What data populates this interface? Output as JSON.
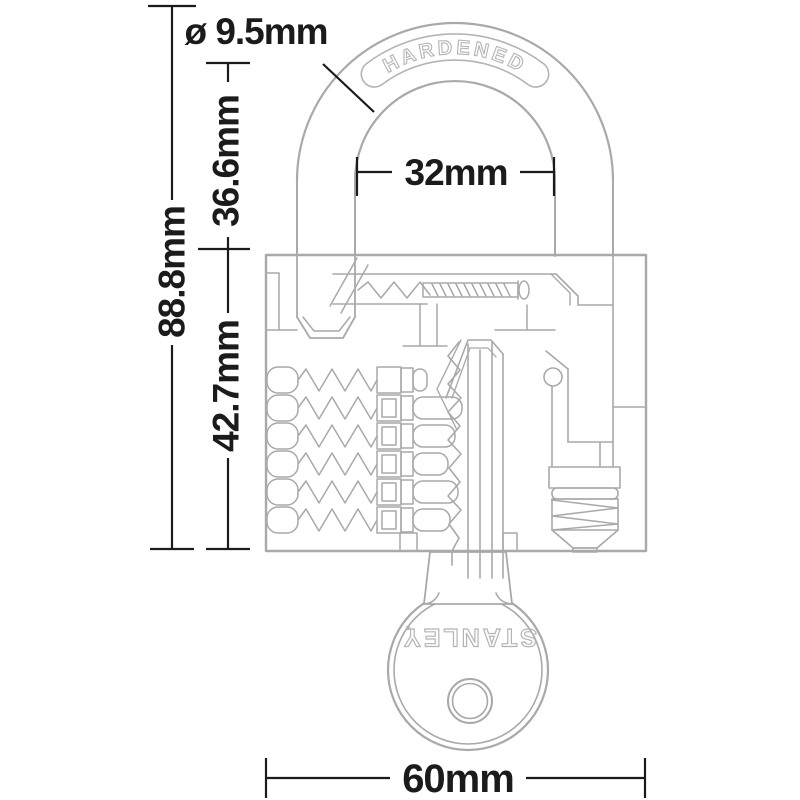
{
  "title": "Padlock technical dimension diagram",
  "dimensions": {
    "overall_height": "88.8mm",
    "shackle_clearance_height": "36.6mm",
    "body_height": "42.7mm",
    "shackle_diameter": "ø 9.5mm",
    "shackle_inner_width": "32mm",
    "body_width": "60mm"
  },
  "labels": {
    "shackle_engraving": "HARDENED",
    "key_brand": "STANLEY"
  },
  "colors": {
    "drawing_stroke": "#a9a9a9",
    "engraving_stroke": "#b4b4b4",
    "dimension_color": "#1b1b1b",
    "background": "#ffffff"
  }
}
